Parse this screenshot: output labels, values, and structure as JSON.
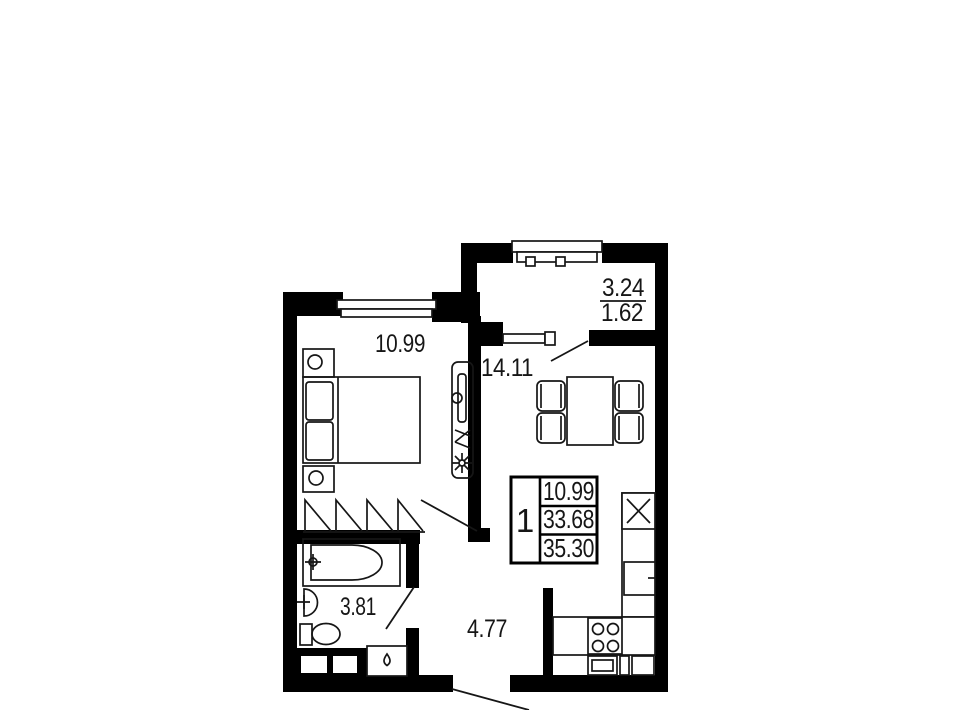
{
  "plan": {
    "colors": {
      "wall": "#000000",
      "background": "#ffffff",
      "ink": "#161616"
    },
    "rooms": {
      "bedroom": {
        "area": "10.99"
      },
      "living_kitchen": {
        "area": "14.11"
      },
      "bathroom": {
        "area": "3.81"
      },
      "hall": {
        "area": "4.77"
      },
      "balcony": {
        "area_total": "3.24",
        "area_coef": "1.62"
      }
    },
    "stamp": {
      "rooms_count": "1",
      "living_area": "10.99",
      "area_main": "33.68",
      "area_total": "35.30"
    }
  }
}
